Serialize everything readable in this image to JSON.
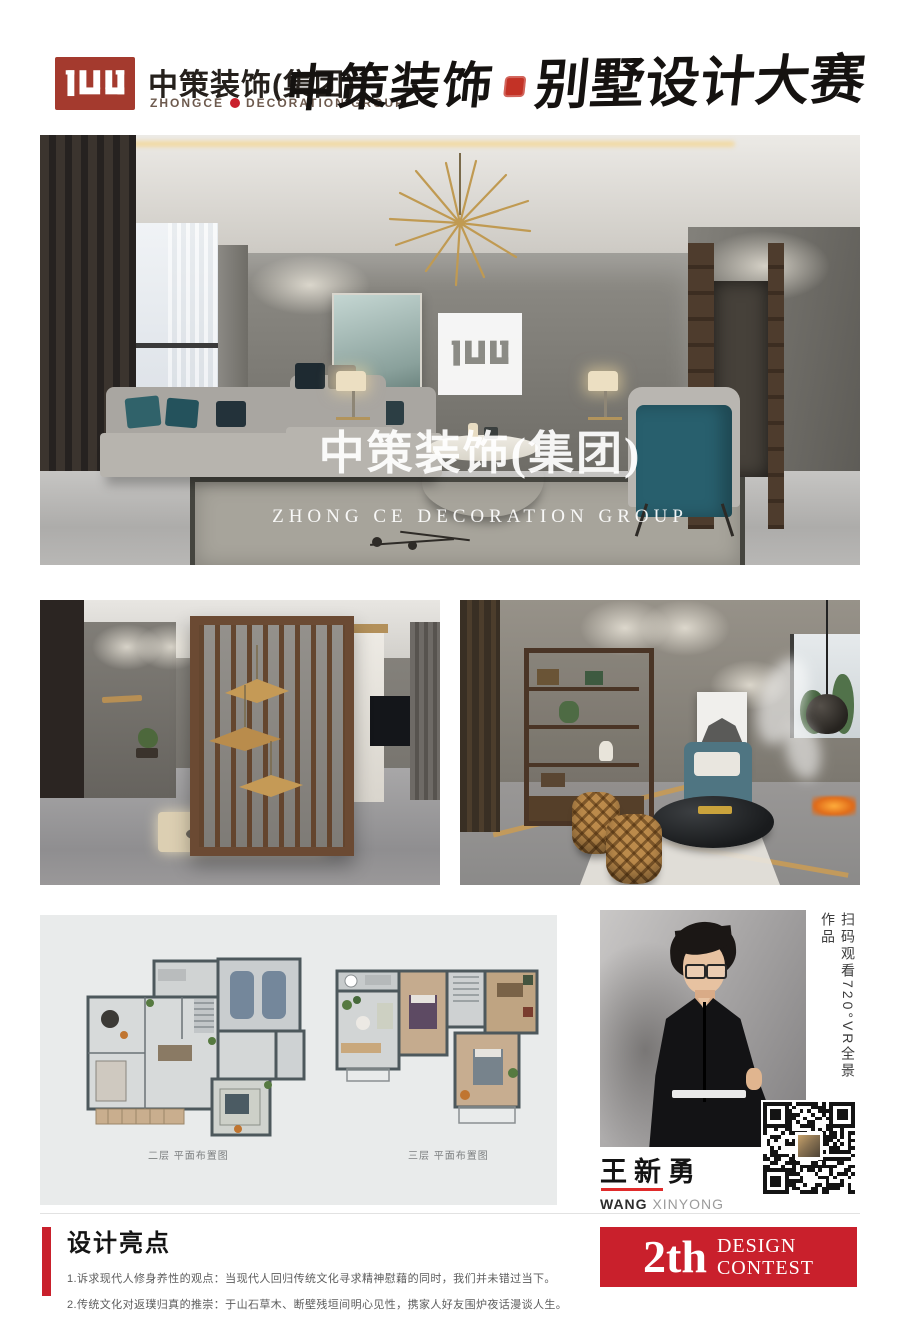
{
  "header": {
    "brand_cn": "中策装饰(集团)",
    "brand_en_1": "ZHONGCE",
    "brand_en_2": "DECORATION GROUP",
    "contest_title_1": "中策装饰",
    "contest_title_2": "别墅设计大赛"
  },
  "hero_watermark": {
    "cn": "中策装饰(集团)",
    "en": "ZHONG CE DECORATION GROUP"
  },
  "floor_plans": {
    "captions": [
      "二层 平面布置图",
      "三层 平面布置图"
    ]
  },
  "designer": {
    "name_cn": "王新勇",
    "name_en_1": "WANG",
    "name_en_2": " XINYONG",
    "vr_caption": "扫码观看720°VR全景作品"
  },
  "highlights": {
    "title": "设计亮点",
    "items": [
      "1.诉求现代人修身养性的观点：当现代人回归传统文化寻求精神慰藉的同时，我们并未错过当下。",
      "2.传统文化对返璞归真的推崇：于山石草木、断壁残垣间明心见性，携家人好友围炉夜话漫谈人生。"
    ]
  },
  "badge": {
    "number": "2th",
    "word_1": "DESIGN",
    "word_2": "CONTEST"
  },
  "colors": {
    "brand_red": "#c9202c",
    "logo_red": "#a43a2e",
    "accent_gold": "#bf9a5e",
    "teal": "#2e6470"
  }
}
